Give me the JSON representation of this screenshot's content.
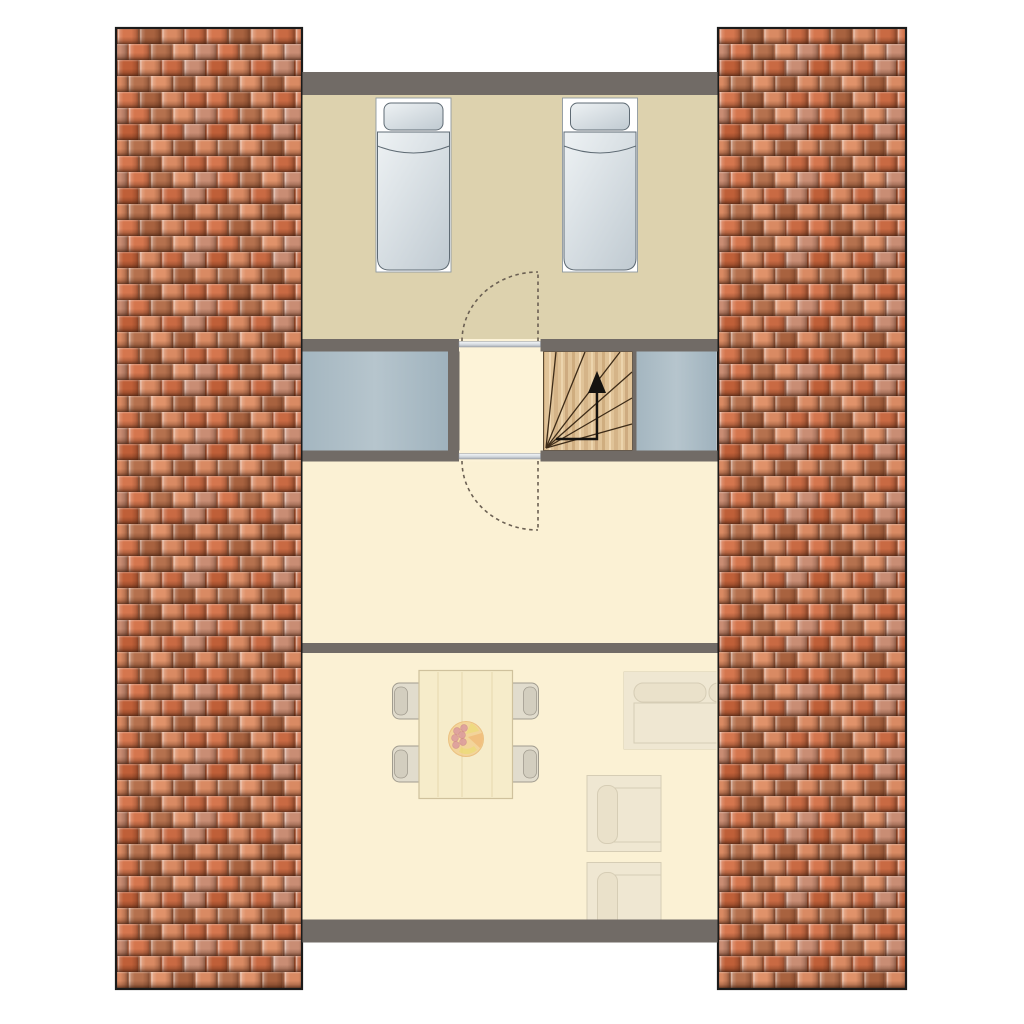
{
  "meta": {
    "title": "Attic floor plan",
    "view": "top-down architectural drawing",
    "text_on_screen": "none"
  },
  "colors": {
    "background": "#ffffff",
    "wall": "#716b66",
    "bedroom_floor": "#ddd2ae",
    "landing_floor": "#fdf3d8",
    "hall_floor": "#fbf1d4",
    "living_floor": "#fbf1d4",
    "void_panel_a": "#a4b6c0",
    "void_panel_b": "#b6c5cd",
    "void_panel_c": "#9fb2bd",
    "stair_wood": "#e0c398",
    "stair_outline": "#5b4a33",
    "tread_line": "#3e2c18",
    "arrow": "#151310",
    "bed_outline": "#5f6b74",
    "bed_sheet": "#ffffff",
    "bed_fill_light": "#eef2f4",
    "bed_fill_dark": "#c2ccd3",
    "door_bar_light": "#f4f6f8",
    "door_bar_dark": "#a9aeb6",
    "door_dash": "#6b6053",
    "table_fill": "#f6ecca",
    "table_outline": "#cfc19c",
    "chair_fill": "#e1dccd",
    "chair_back": "#d3cebf",
    "chair_outline": "#a19c8f",
    "sofa_fill": "#efe7d2",
    "sofa_outline": "#d6cdb5",
    "sofa_inner": "#eae1ca",
    "plate": "#f3cf8f",
    "plate_rim": "#e9b76f",
    "grapes": "#d98f94",
    "grapes_outline": "#c8797f",
    "banana": "#ecd66d",
    "orange_fruit": "#f0b269",
    "tile_border": "#1b1b1b"
  },
  "tiles": {
    "tile_width": 22.25,
    "tile_height": 16,
    "rows": [
      [
        "#d5764e",
        "#a8623f",
        "#d98a63",
        "#c96a43"
      ],
      [
        "#c98d74",
        "#d5764e",
        "#b5714e",
        "#e0926a"
      ],
      [
        "#bf5f38",
        "#d98a63",
        "#c96a43",
        "#c98d74"
      ],
      [
        "#d98a63",
        "#b5714e",
        "#e0926a",
        "#a8623f"
      ]
    ]
  },
  "roof": {
    "left_strip": "pantile roof surface",
    "right_strip": "pantile roof surface"
  },
  "rooms": [
    {
      "name": "bedroom",
      "position": "top",
      "furniture": [
        "single-bed",
        "single-bed"
      ]
    },
    {
      "name": "landing",
      "position": "middle",
      "features": [
        "doorway-to-bedroom",
        "doorway-to-hall",
        "winder-staircase"
      ]
    },
    {
      "name": "hall",
      "position": "middle-lower",
      "furniture": []
    },
    {
      "name": "living-room",
      "position": "bottom",
      "furniture": [
        "dining-table",
        "chair",
        "chair",
        "chair",
        "chair",
        "fruit-bowl",
        "sofa",
        "armchair",
        "armchair"
      ]
    }
  ],
  "stairs": {
    "type": "winder (fan steps)",
    "direction": "up",
    "tread_lines": 6,
    "arrow": "L-shaped, pointing up"
  },
  "doors": [
    {
      "between": "bedroom and landing",
      "swing": "into bedroom",
      "style": "dashed quarter arc"
    },
    {
      "between": "landing and hall",
      "swing": "into hall",
      "style": "dashed quarter arc"
    }
  ]
}
